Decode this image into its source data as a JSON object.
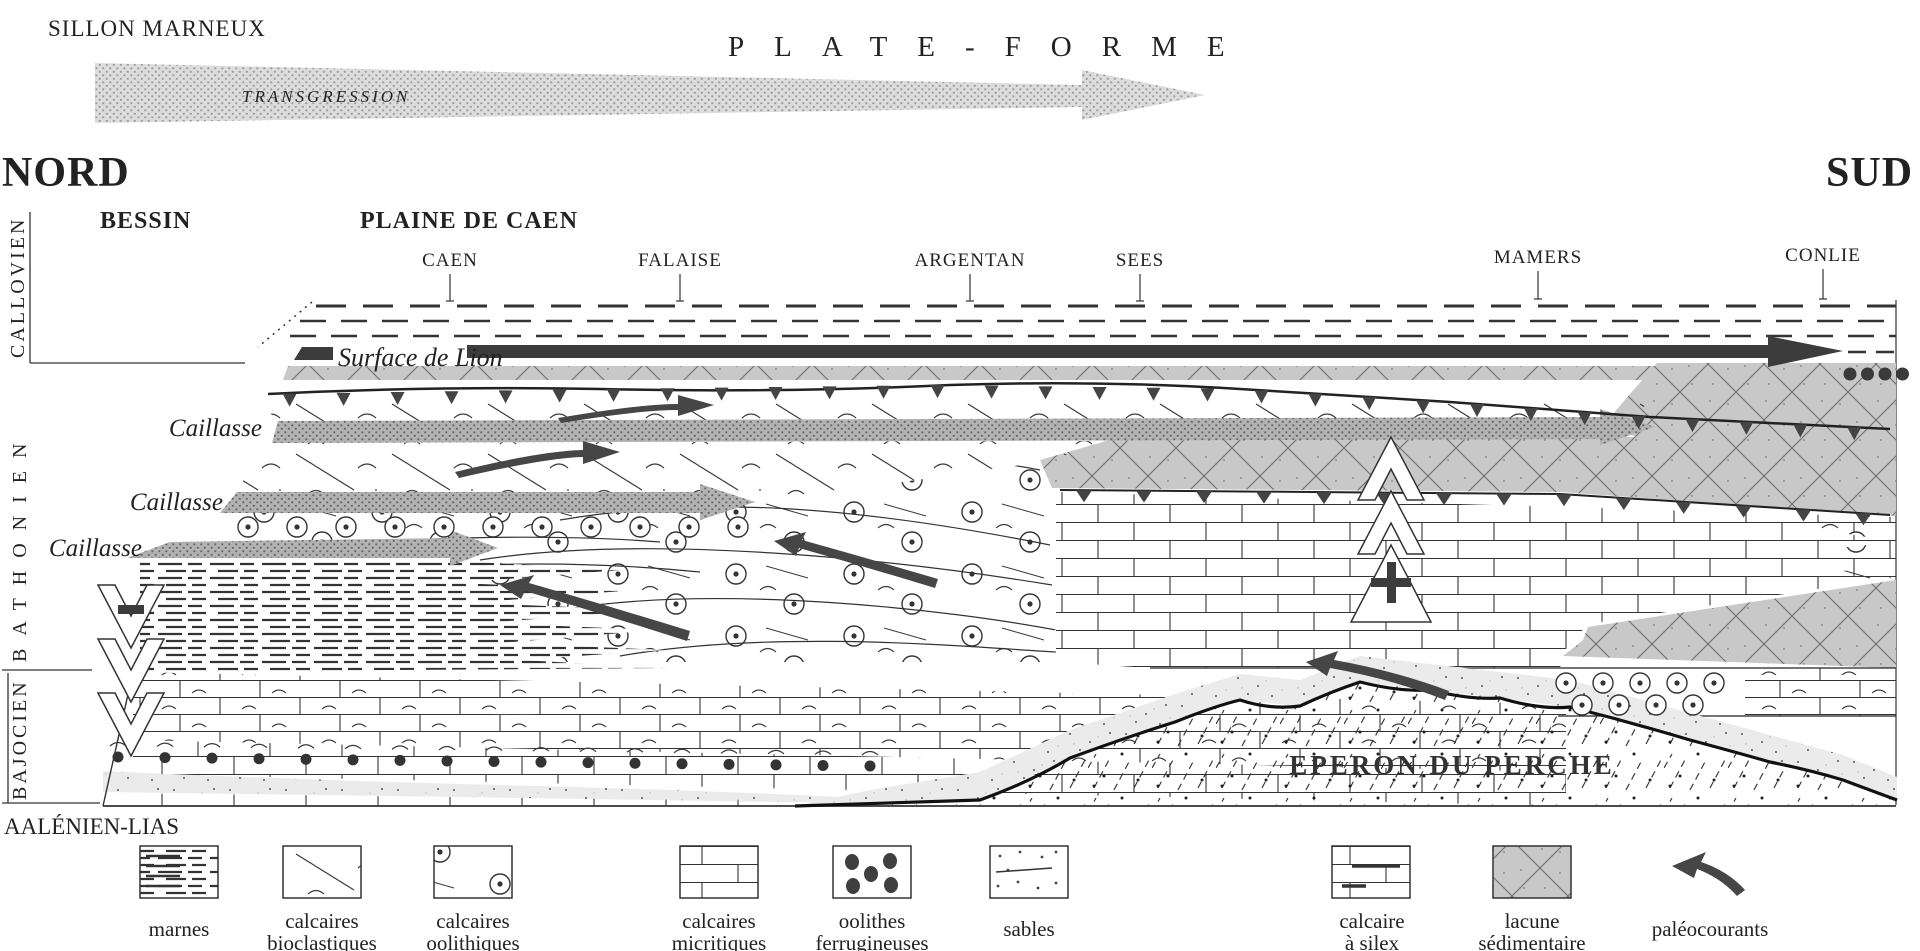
{
  "header": {
    "sillon": "SILLON MARNEUX",
    "plateforme": "PLATE-FORME",
    "transgression": "TRANSGRESSION",
    "nord": "NORD",
    "sud": "SUD",
    "bessin": "BESSIN",
    "plaine_de_caen": "PLAINE DE CAEN"
  },
  "towns": [
    "CAEN",
    "FALAISE",
    "ARGENTAN",
    "SEES",
    "MAMERS",
    "CONLIE"
  ],
  "stages": [
    "CALLOVIEN",
    "BATHONIEN",
    "BAJOCIEN",
    "AALÉNIEN-LIAS"
  ],
  "annotations": {
    "surface_de_lion": "Surface de Lion",
    "caillasse": "Caillasse",
    "eperon": "EPERON DU PERCHE",
    "plus": "+",
    "minus": "-"
  },
  "legend": {
    "items": [
      {
        "line1": "marnes",
        "line2": "",
        "pattern": "marnes-dashes"
      },
      {
        "line1": "calcaires",
        "line2": "bioclastiques",
        "pattern": "oblique-bricks-shell-curves"
      },
      {
        "line1": "calcaires",
        "line2": "oolithiques",
        "pattern": "oblique-bricks-circled-dots"
      },
      {
        "line1": "calcaires",
        "line2": "micritiques",
        "pattern": "bricks"
      },
      {
        "line1": "oolithes",
        "line2": "ferrugineuses",
        "pattern": "dark-dots"
      },
      {
        "line1": "sables",
        "line2": "",
        "pattern": "fine-dots"
      },
      {
        "line1": "calcaire",
        "line2": "à silex",
        "pattern": "bricks-flint-dashes"
      },
      {
        "line1": "lacune",
        "line2": "sédimentaire",
        "pattern": "grey-crosshatch"
      },
      {
        "line1": "paléocourants",
        "line2": "",
        "pattern": "curved-arrow"
      }
    ]
  },
  "colors": {
    "ink": "#222222",
    "dark_arrow": "#414141",
    "caillasse_grey": "#a8a8a8",
    "lacune_grey": "#c8c8c8",
    "sand_grey": "#ebebeb",
    "transgression_grey": "#d6d6d6",
    "paper": "#ffffff"
  }
}
